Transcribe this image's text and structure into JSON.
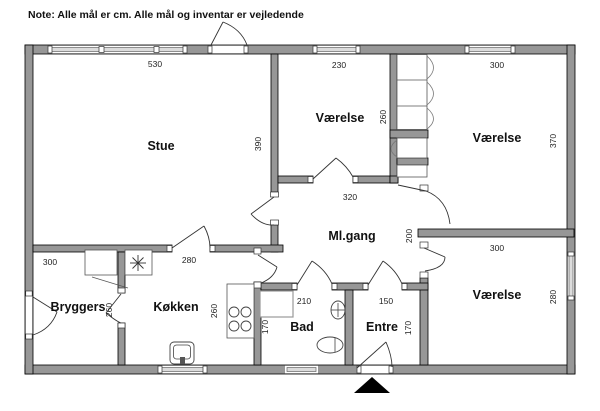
{
  "note": "Note: Alle mål er cm. Alle mål og inventar er vejledende",
  "unit": "cm",
  "rooms": [
    {
      "name": "Stue",
      "width_cm": "530",
      "depth_cm": "390"
    },
    {
      "name": "Værelse",
      "width_cm": "230",
      "depth_cm": "260"
    },
    {
      "name": "Værelse",
      "width_cm": "300",
      "depth_cm": "370"
    },
    {
      "name": "Ml.gang",
      "width_cm": "320",
      "depth_cm": "200"
    },
    {
      "name": "Værelse",
      "width_cm": "300",
      "depth_cm": "280"
    },
    {
      "name": "Bryggers",
      "width_cm": "300",
      "depth_cm": "260"
    },
    {
      "name": "Køkken",
      "width_cm": "280",
      "depth_cm": "260"
    },
    {
      "name": "Bad",
      "width_cm": "210",
      "depth_cm": "170"
    },
    {
      "name": "Entre",
      "width_cm": "150",
      "depth_cm": "170"
    }
  ],
  "colors": {
    "wall": "#979797",
    "window": "#dcdcdc",
    "marker": "#000000"
  }
}
